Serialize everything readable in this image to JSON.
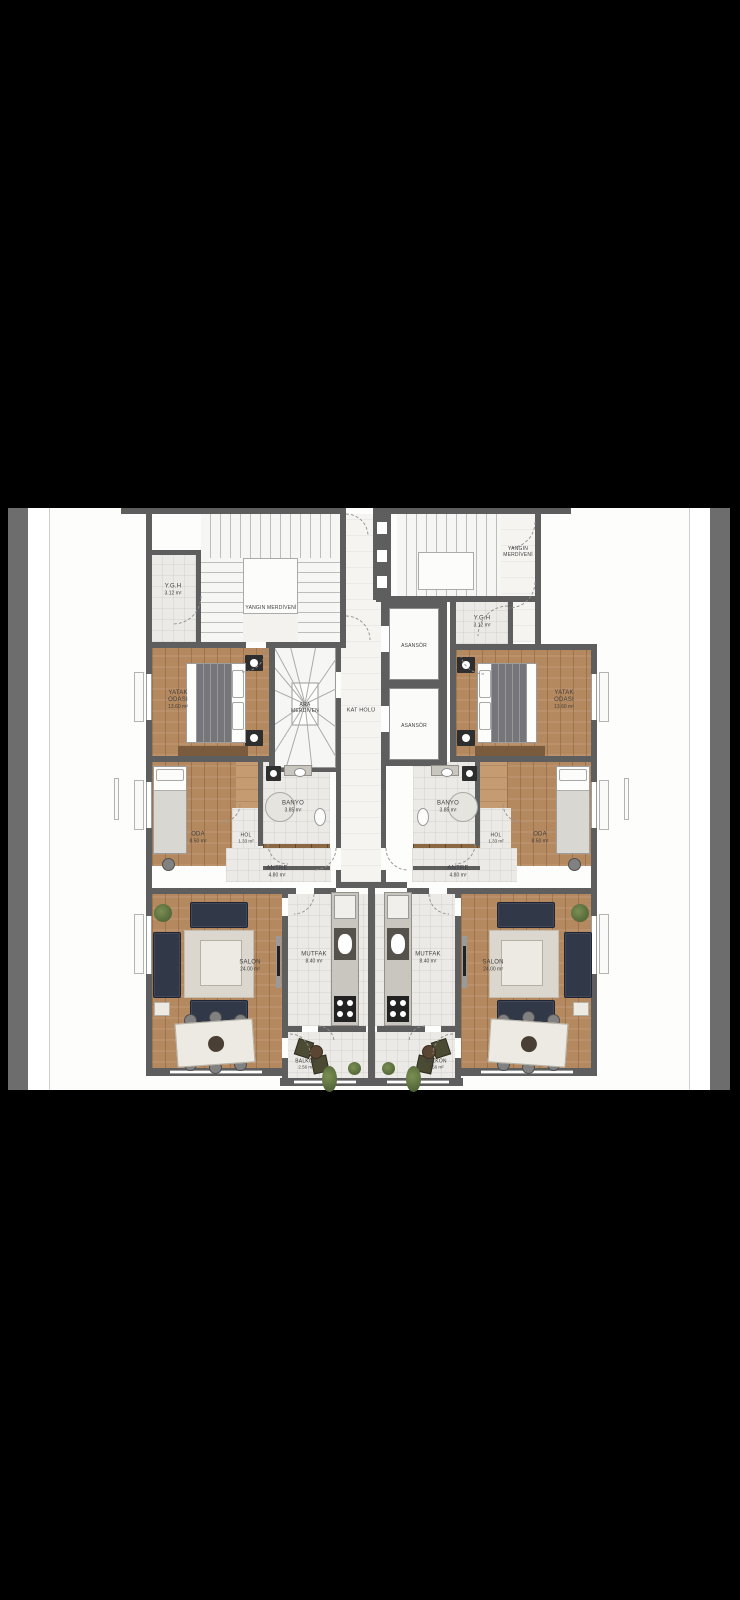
{
  "colors": {
    "background": "#000000",
    "page_white": "#ffffff",
    "adjacent_image_gray": "#6d6d6d",
    "wall_gray": "#5e5e5e",
    "wood_floor": "#b5895f",
    "sofa_navy": "#313848",
    "plant_green": "#55693a"
  },
  "floor_plan": {
    "common": {
      "yangin_merdiveni_left": {
        "label": "YANGIN MERDİVENİ"
      },
      "yangin_merdiveni_right": {
        "label": "YANGIN MERDİVENİ"
      },
      "ygh_left": {
        "label": "Y.G.H",
        "area": "3.12 m²"
      },
      "ygh_right": {
        "label": "Y.G.H",
        "area": "3.12 m²"
      },
      "ara_merdiven": {
        "label": "ARA MERDİVEN"
      },
      "kat_holu": {
        "label": "KAT HOLÜ"
      },
      "asansor_upper": {
        "label": "ASANSÖR"
      },
      "asansor_lower": {
        "label": "ASANSÖR"
      }
    },
    "apartment_left": {
      "yatak_odasi": {
        "label": "YATAK ODASI",
        "area": "13.60 m²"
      },
      "oda": {
        "label": "ODA",
        "area": "8.50 m²"
      },
      "hol": {
        "label": "HOL",
        "area": "1.33 m²"
      },
      "banyo": {
        "label": "BANYO",
        "area": "3.85 m²"
      },
      "antre": {
        "label": "ANTRE",
        "area": "4.80 m²"
      },
      "salon": {
        "label": "SALON",
        "area": "24.00 m²"
      },
      "mutfak": {
        "label": "MUTFAK",
        "area": "8.40 m²"
      },
      "balkon": {
        "label": "BALKON",
        "area": "2.56 m²"
      }
    },
    "apartment_right": {
      "yatak_odasi": {
        "label": "YATAK ODASI",
        "area": "13.60 m²"
      },
      "oda": {
        "label": "ODA",
        "area": "8.50 m²"
      },
      "hol": {
        "label": "HOL",
        "area": "1.33 m²"
      },
      "banyo": {
        "label": "BANYO",
        "area": "3.85 m²"
      },
      "antre": {
        "label": "ANTRE",
        "area": "4.80 m²"
      },
      "salon": {
        "label": "SALON",
        "area": "24.00 m²"
      },
      "mutfak": {
        "label": "MUTFAK",
        "area": "8.40 m²"
      },
      "balkon": {
        "label": "BALKON",
        "area": "2.56 m²"
      }
    }
  }
}
